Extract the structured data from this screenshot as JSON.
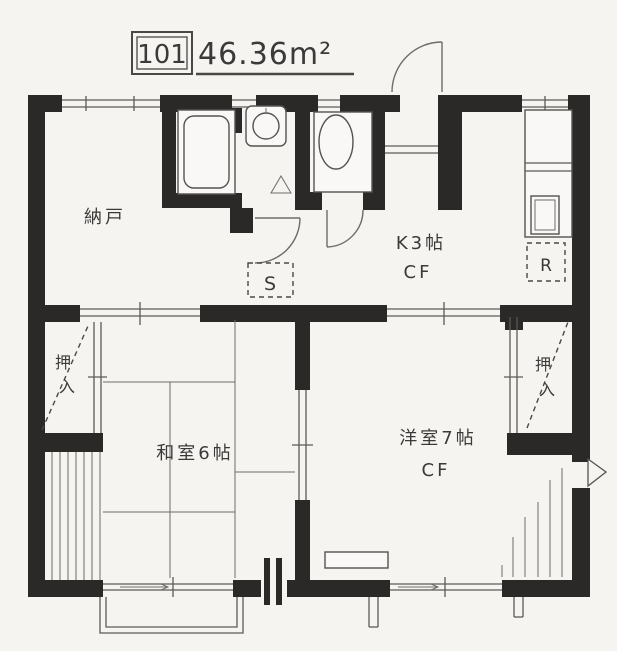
{
  "colors": {
    "paper": "#f6f4f1",
    "wall_ink": "#2b2927",
    "line": "#5c5a57",
    "text": "#3a3a3a"
  },
  "header": {
    "unit_number": "101",
    "area": "46.36m²"
  },
  "rooms": {
    "storage": {
      "label": "納戸"
    },
    "kitchen": {
      "label": "K3帖",
      "floor": "CF"
    },
    "western": {
      "label": "洋室7帖",
      "floor": "CF"
    },
    "japanese": {
      "label": "和室6帖"
    },
    "closet_left": {
      "chars": [
        "押",
        "入"
      ]
    },
    "closet_right": {
      "chars": [
        "押",
        "入"
      ]
    },
    "washer_spot": {
      "label": "S"
    },
    "fridge_spot": {
      "label": "R"
    }
  }
}
